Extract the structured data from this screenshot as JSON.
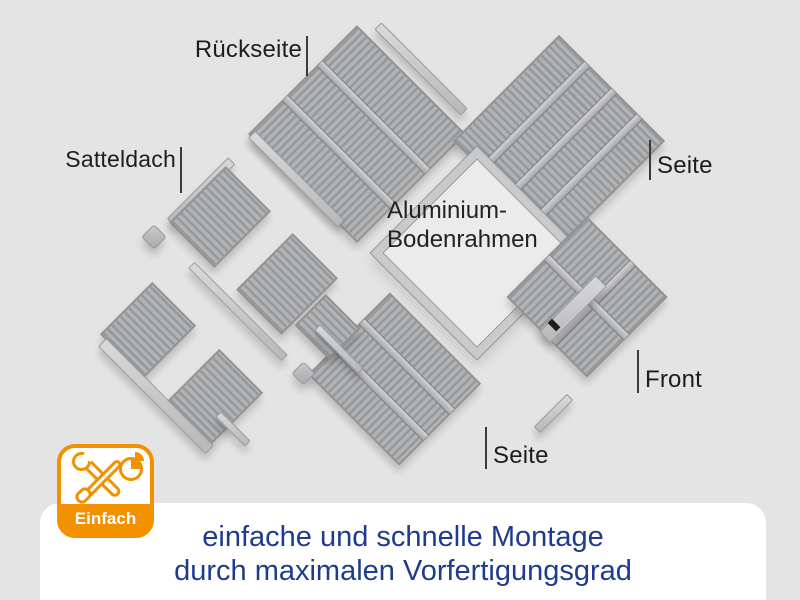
{
  "page": {
    "background_color": "#e4e4e5"
  },
  "diagram": {
    "labels": {
      "rueckseite": "Rückseite",
      "satteldach": "Satteldach",
      "bodenrahmen_line1": "Aluminium-",
      "bodenrahmen_line2": "Bodenrahmen",
      "seite_right": "Seite",
      "front": "Front",
      "seite_bottom": "Seite"
    },
    "parts": [
      "rueckseite-panel",
      "satteldach-roof-panels",
      "aluminium-bodenrahmen-frame",
      "seite-panel-right",
      "seite-panel-bottom",
      "front-panel-with-door",
      "corner-rails",
      "edge-caps"
    ],
    "colors": {
      "panel_gray": "#a9abad",
      "rib_dark": "#96989a",
      "rib_light": "#b2b3b5",
      "rail_light": "#c6c7c9",
      "frame_gray": "#c9cacc"
    }
  },
  "badge": {
    "label": "Einfach",
    "accent_color": "#f29100",
    "icons": [
      "wrench-icon",
      "screwdriver-icon",
      "pie-chart-icon"
    ]
  },
  "caption": {
    "line1": "einfache und schnelle Montage",
    "line2": "durch maximalen Vorfertigungsgrad",
    "text_color": "#1e3b8c"
  }
}
